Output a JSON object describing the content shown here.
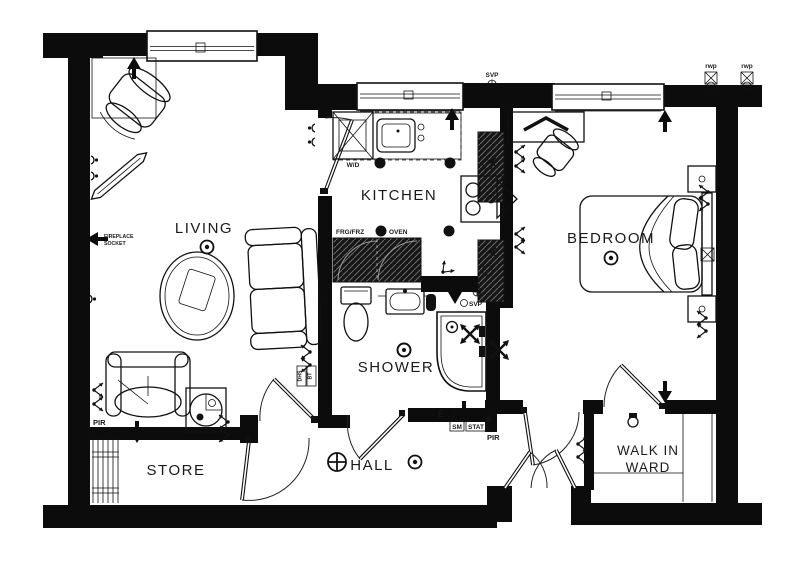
{
  "drawing": {
    "rooms": {
      "living": "LIVING",
      "kitchen": "KITCHEN",
      "bedroom": "BEDROOM",
      "shower": "SHOWER",
      "hall": "HALL",
      "store": "STORE",
      "walkin_line1": "WALK IN",
      "walkin_line2": "WARD"
    },
    "appliances": {
      "washer_dryer": "W/D",
      "fridge_freezer": "FRG/FRZ",
      "oven": "OVEN"
    },
    "services": {
      "svp_top": "SVP",
      "svp_shower": "SVP",
      "rwp_left": "rwp",
      "rwp_right": "rwp",
      "fireplace_line1": "FIREPLACE",
      "fireplace_line2": "SOCKET",
      "pir_living": "PIR",
      "pir_hall": "PIR",
      "smoke_detector": "SM",
      "thermostat": "STAT",
      "emergency": "E",
      "dhs": "DHS",
      "bt": "BT"
    },
    "colors": {
      "wall": "#0c0c0c",
      "background": "#ffffff",
      "counter_fill": "#161616"
    }
  }
}
